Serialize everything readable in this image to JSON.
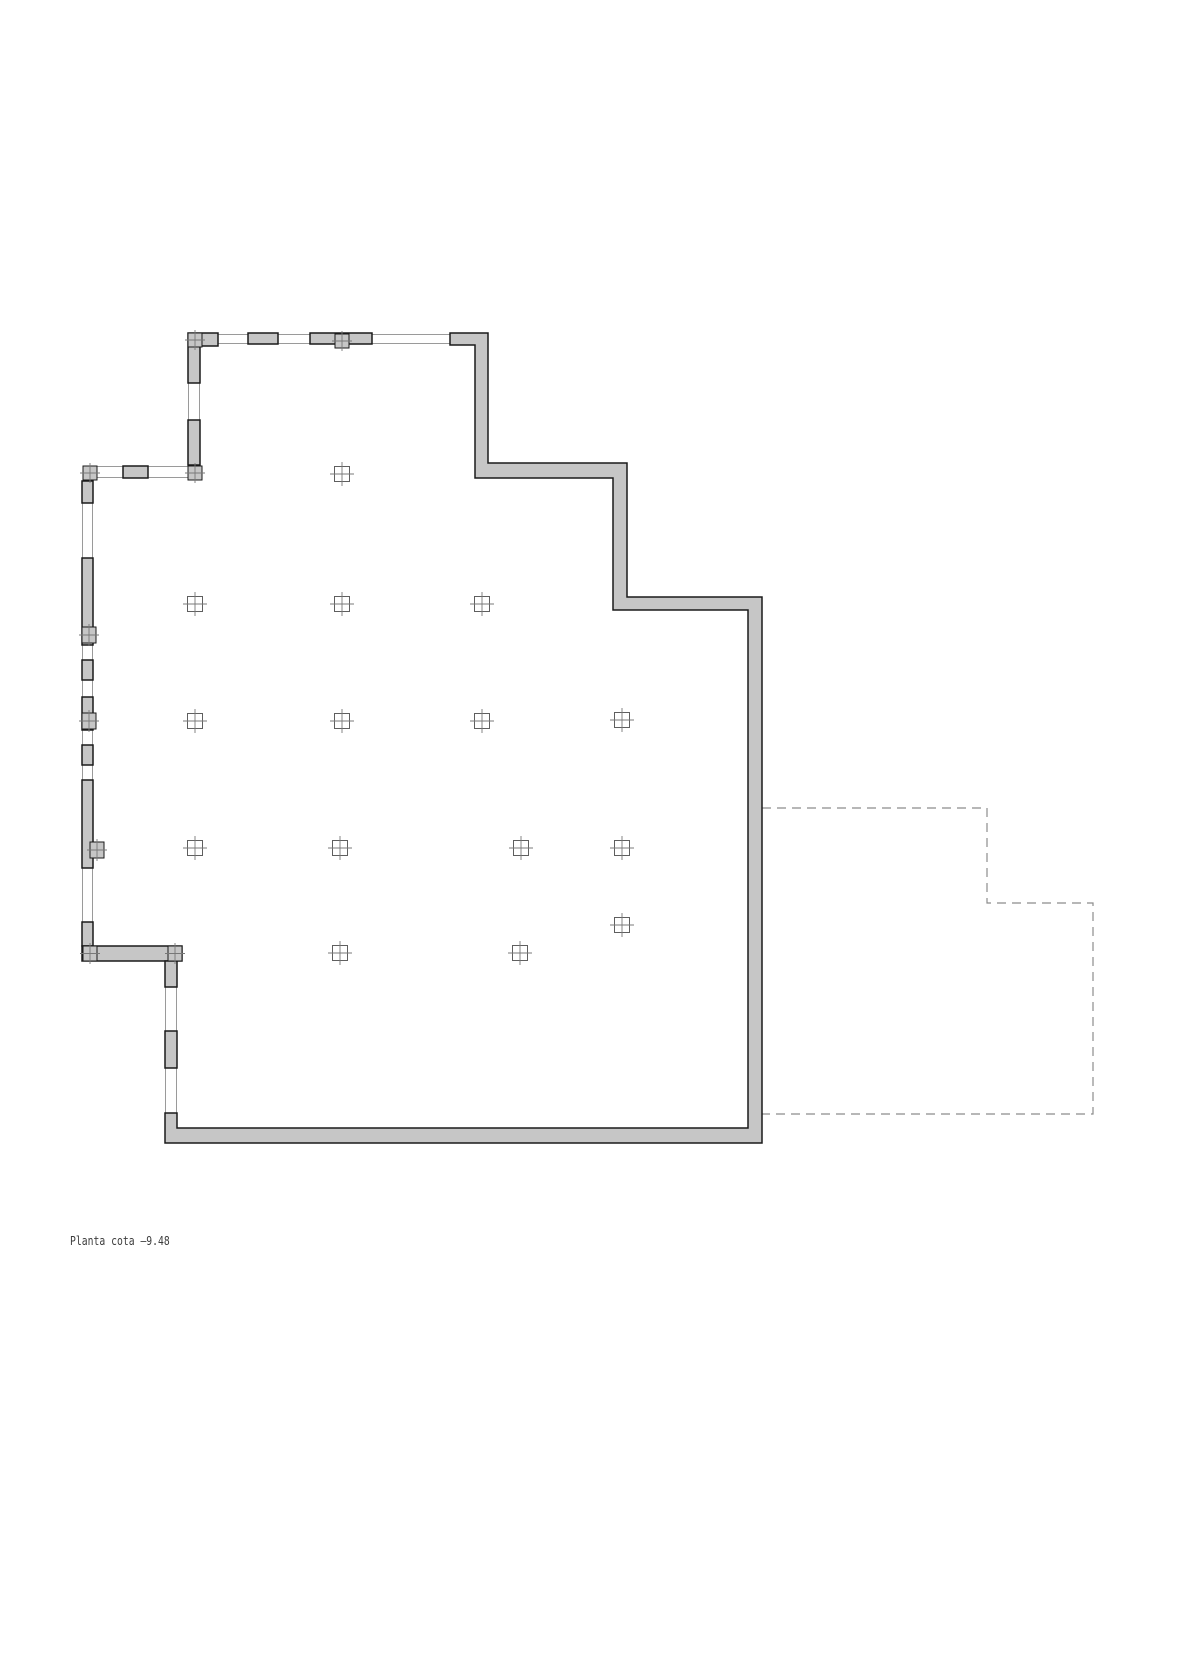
{
  "drawing": {
    "title_label": "Planta cota –9.48",
    "colors": {
      "background": "#ffffff",
      "wall_fill": "#c6c6c6",
      "wall_stroke": "#1a1a1a",
      "thin_line": "#9a9a9a",
      "dashed_line": "#8c8c8c",
      "marker_stroke": "#5f5f5f",
      "cross_stroke": "#787878",
      "text": "#3c3c3c"
    },
    "stroke_widths": {
      "wall": 1.5,
      "thin": 1,
      "dashed": 1.2,
      "marker": 1,
      "cross": 0.9
    },
    "dash_pattern": "9 6",
    "wall_paths": [
      [
        [
          450,
          333
        ],
        [
          488,
          333
        ],
        [
          488,
          463
        ],
        [
          627,
          463
        ],
        [
          627,
          597
        ],
        [
          762,
          597
        ],
        [
          762,
          1143
        ],
        [
          165,
          1143
        ],
        [
          165,
          1113
        ],
        [
          177,
          1113
        ],
        [
          177,
          1128
        ],
        [
          748,
          1128
        ],
        [
          748,
          610
        ],
        [
          613,
          610
        ],
        [
          613,
          478
        ],
        [
          475,
          478
        ],
        [
          475,
          345
        ],
        [
          450,
          345
        ]
      ],
      [
        [
          188,
          333
        ],
        [
          218,
          333
        ],
        [
          218,
          346
        ],
        [
          200,
          346
        ],
        [
          200,
          383
        ],
        [
          188,
          383
        ]
      ]
    ],
    "wall_rects": [
      {
        "x": 248,
        "y": 333,
        "w": 30,
        "h": 11
      },
      {
        "x": 310,
        "y": 333,
        "w": 62,
        "h": 11
      },
      {
        "x": 188,
        "y": 420,
        "w": 12,
        "h": 45
      },
      {
        "x": 123,
        "y": 466,
        "w": 25,
        "h": 12
      },
      {
        "x": 82,
        "y": 481,
        "w": 11,
        "h": 22
      },
      {
        "x": 82,
        "y": 558,
        "w": 11,
        "h": 87
      },
      {
        "x": 82,
        "y": 660,
        "w": 11,
        "h": 20
      },
      {
        "x": 82,
        "y": 697,
        "w": 11,
        "h": 33
      },
      {
        "x": 82,
        "y": 745,
        "w": 11,
        "h": 20
      },
      {
        "x": 82,
        "y": 780,
        "w": 11,
        "h": 88
      },
      {
        "x": 82,
        "y": 922,
        "w": 11,
        "h": 24
      },
      {
        "x": 82,
        "y": 946,
        "w": 100,
        "h": 15
      },
      {
        "x": 165,
        "y": 961,
        "w": 12,
        "h": 26
      },
      {
        "x": 165,
        "y": 1031,
        "w": 12,
        "h": 37
      }
    ],
    "thin_lines": [
      [
        218,
        334.5,
        450,
        334.5
      ],
      [
        218,
        343.5,
        450,
        343.5
      ],
      [
        97,
        466.5,
        188,
        466.5
      ],
      [
        97,
        477.5,
        188,
        477.5
      ],
      [
        188.5,
        346,
        188.5,
        465
      ],
      [
        199.5,
        346,
        199.5,
        465
      ],
      [
        82.5,
        481,
        82.5,
        946
      ],
      [
        92.5,
        481,
        92.5,
        946
      ],
      [
        165.5,
        961,
        165.5,
        1128
      ],
      [
        176.5,
        961,
        176.5,
        1128
      ]
    ],
    "dashed_path": [
      [
        762,
        808
      ],
      [
        987,
        808
      ],
      [
        987,
        903
      ],
      [
        1093,
        903
      ],
      [
        1093,
        1114
      ],
      [
        762,
        1114
      ]
    ],
    "wall_columns": [
      {
        "x": 188,
        "y": 333,
        "w": 14,
        "h": 14
      },
      {
        "x": 335,
        "y": 334,
        "w": 14,
        "h": 14
      },
      {
        "x": 83,
        "y": 466,
        "w": 14,
        "h": 14
      },
      {
        "x": 188,
        "y": 466,
        "w": 14,
        "h": 14
      },
      {
        "x": 82,
        "y": 627,
        "w": 14,
        "h": 16
      },
      {
        "x": 82,
        "y": 713,
        "w": 14,
        "h": 16
      },
      {
        "x": 90,
        "y": 842,
        "w": 14,
        "h": 16
      },
      {
        "x": 83,
        "y": 946,
        "w": 14,
        "h": 15
      },
      {
        "x": 168,
        "y": 946,
        "w": 14,
        "h": 15
      }
    ],
    "wall_column_cross_overhang": 3,
    "grid_markers": [
      {
        "x": 342,
        "y": 474
      },
      {
        "x": 195,
        "y": 604
      },
      {
        "x": 342,
        "y": 604
      },
      {
        "x": 482,
        "y": 604
      },
      {
        "x": 195,
        "y": 721
      },
      {
        "x": 342,
        "y": 721
      },
      {
        "x": 482,
        "y": 721
      },
      {
        "x": 622,
        "y": 720
      },
      {
        "x": 195,
        "y": 848
      },
      {
        "x": 340,
        "y": 848
      },
      {
        "x": 521,
        "y": 848
      },
      {
        "x": 622,
        "y": 848
      },
      {
        "x": 622,
        "y": 925
      },
      {
        "x": 340,
        "y": 953
      },
      {
        "x": 520,
        "y": 953
      }
    ],
    "grid_marker_size": 15,
    "grid_marker_cross_overhang": 4.5
  }
}
